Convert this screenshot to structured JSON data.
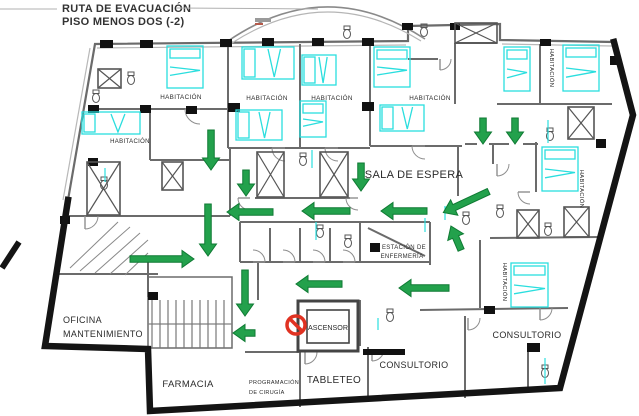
{
  "title": {
    "line1": "RUTA DE EVACUACIÓN",
    "line2": "PISO MENOS DOS (-2)"
  },
  "colors": {
    "outer_wall": "#141414",
    "inner_wall": "#6b6b6b",
    "light_wall": "#b8b8b8",
    "bed": "#2adede",
    "arrow_fill": "#23a14c",
    "arrow_edge": "#0f7a33",
    "prohibited": "#e03222",
    "label": "#2b2b2b",
    "block": "#111111"
  },
  "plan": {
    "outline": [
      [
        95,
        44
      ],
      [
        408,
        41
      ],
      [
        408,
        26
      ],
      [
        500,
        24
      ],
      [
        500,
        40
      ],
      [
        614,
        42
      ],
      [
        633,
        115
      ],
      [
        560,
        388
      ],
      [
        150,
        411
      ],
      [
        148,
        349
      ],
      [
        45,
        346
      ],
      [
        68,
        200
      ]
    ],
    "thick_edge": [
      [
        614,
        42
      ],
      [
        633,
        115
      ],
      [
        560,
        388
      ],
      [
        150,
        411
      ],
      [
        148,
        349
      ],
      [
        45,
        346
      ],
      [
        68,
        200
      ]
    ],
    "thick_stub": [
      2,
      268,
      19,
      242
    ],
    "inner_parallels": [
      [
        97,
        48,
        406,
        45
      ],
      [
        502,
        44,
        612,
        46
      ],
      [
        90,
        48,
        63,
        200
      ]
    ],
    "canopy_paths": [
      "M228,41 Q326,-26 425,39",
      "M232,43 Q326,-18 421,41"
    ],
    "smudges": [
      [
        255,
        18,
        16,
        4,
        "#9a9a9a"
      ],
      [
        255,
        23,
        8,
        2,
        "#b55a4a"
      ]
    ],
    "leaders": [
      [
        0,
        9,
        57,
        9
      ],
      [
        176,
        8,
        318,
        9
      ]
    ],
    "walls": [
      [
        95,
        109,
        228,
        109
      ],
      [
        228,
        44,
        228,
        148
      ],
      [
        300,
        44,
        300,
        148
      ],
      [
        370,
        42,
        370,
        146
      ],
      [
        228,
        148,
        370,
        148
      ],
      [
        370,
        146,
        462,
        146
      ],
      [
        465,
        144,
        477,
        144
      ],
      [
        489,
        144,
        509,
        144
      ],
      [
        523,
        144,
        538,
        144
      ],
      [
        536,
        142,
        536,
        192
      ],
      [
        540,
        44,
        540,
        104
      ],
      [
        497,
        104,
        612,
        104
      ],
      [
        455,
        43,
        455,
        104
      ],
      [
        455,
        43,
        497,
        43
      ],
      [
        408,
        59,
        438,
        59
      ],
      [
        458,
        146,
        458,
        196
      ],
      [
        493,
        144,
        493,
        164
      ],
      [
        490,
        238,
        600,
        237
      ],
      [
        150,
        109,
        150,
        160
      ],
      [
        150,
        160,
        230,
        160
      ],
      [
        230,
        148,
        230,
        216
      ],
      [
        68,
        216,
        230,
        216
      ],
      [
        255,
        198,
        350,
        198
      ],
      [
        240,
        222,
        430,
        222
      ],
      [
        240,
        262,
        430,
        262
      ],
      [
        240,
        222,
        240,
        262
      ],
      [
        270,
        228,
        270,
        262
      ],
      [
        300,
        228,
        300,
        262
      ],
      [
        330,
        228,
        330,
        262
      ],
      [
        360,
        222,
        360,
        262
      ],
      [
        430,
        222,
        430,
        265
      ],
      [
        57,
        274,
        158,
        274
      ],
      [
        258,
        262,
        258,
        300
      ],
      [
        245,
        352,
        300,
        352
      ],
      [
        300,
        350,
        300,
        407
      ],
      [
        368,
        347,
        368,
        402
      ],
      [
        465,
        316,
        465,
        398
      ],
      [
        420,
        310,
        568,
        308
      ],
      [
        480,
        240,
        480,
        308
      ],
      [
        360,
        300,
        360,
        346
      ],
      [
        368,
        228,
        425,
        256
      ],
      [
        528,
        352,
        528,
        392
      ],
      [
        148,
        262,
        148,
        297
      ]
    ],
    "blocks": [
      [
        100,
        40,
        13,
        8
      ],
      [
        140,
        40,
        13,
        8
      ],
      [
        220,
        39,
        12,
        8
      ],
      [
        262,
        38,
        12,
        8
      ],
      [
        312,
        38,
        12,
        8
      ],
      [
        362,
        38,
        12,
        8
      ],
      [
        402,
        23,
        11,
        7
      ],
      [
        450,
        23,
        10,
        7
      ],
      [
        540,
        39,
        11,
        7
      ],
      [
        88,
        105,
        11,
        8
      ],
      [
        140,
        105,
        11,
        8
      ],
      [
        186,
        106,
        11,
        8
      ],
      [
        228,
        103,
        12,
        9
      ],
      [
        362,
        102,
        12,
        9
      ],
      [
        88,
        158,
        10,
        8
      ],
      [
        60,
        216,
        10,
        8
      ],
      [
        370,
        243,
        10,
        9
      ],
      [
        148,
        292,
        10,
        8
      ],
      [
        527,
        343,
        13,
        9
      ],
      [
        363,
        349,
        42,
        6
      ],
      [
        596,
        139,
        10,
        9
      ],
      [
        610,
        56,
        10,
        9
      ],
      [
        484,
        306,
        11,
        8
      ]
    ],
    "shafts": [
      [
        257,
        152,
        27,
        45
      ],
      [
        320,
        152,
        28,
        45
      ],
      [
        455,
        23,
        42,
        20
      ],
      [
        568,
        107,
        26,
        32
      ],
      [
        517,
        210,
        22,
        28
      ],
      [
        564,
        207,
        25,
        30
      ],
      [
        87,
        162,
        33,
        53
      ],
      [
        162,
        162,
        21,
        28
      ],
      [
        98,
        69,
        23,
        19
      ]
    ],
    "beds": [
      [
        167,
        46,
        36,
        42
      ],
      [
        242,
        47,
        52,
        32
      ],
      [
        236,
        110,
        46,
        30
      ],
      [
        302,
        55,
        34,
        30
      ],
      [
        300,
        101,
        26,
        36
      ],
      [
        374,
        47,
        36,
        40
      ],
      [
        380,
        105,
        44,
        26
      ],
      [
        82,
        112,
        58,
        22
      ],
      [
        504,
        47,
        26,
        44
      ],
      [
        563,
        45,
        36,
        46
      ],
      [
        542,
        147,
        36,
        44
      ],
      [
        511,
        263,
        37,
        44
      ]
    ],
    "stairs": {
      "box": [
        148,
        277,
        84,
        71
      ],
      "rail": [
        148,
        324,
        232,
        324
      ],
      "tread_x": [
        152,
        160,
        168,
        176,
        184,
        192,
        200,
        208,
        216,
        224
      ],
      "tread_y1": 300,
      "tread_y2": 348,
      "diagonals": [
        [
          70,
          268,
          118,
          222
        ],
        [
          80,
          271,
          130,
          227
        ],
        [
          95,
          273,
          140,
          233
        ],
        [
          110,
          274,
          148,
          240
        ],
        [
          125,
          275,
          148,
          253
        ]
      ]
    },
    "doors": [
      [
        200,
        109,
        15,
        90
      ],
      [
        285,
        148,
        13,
        90
      ],
      [
        338,
        148,
        13,
        90
      ],
      [
        425,
        146,
        13,
        90
      ],
      [
        250,
        198,
        12,
        90
      ],
      [
        358,
        198,
        12,
        90
      ],
      [
        253,
        262,
        12,
        270
      ],
      [
        283,
        262,
        12,
        270
      ],
      [
        313,
        262,
        12,
        270
      ],
      [
        343,
        262,
        12,
        270
      ],
      [
        85,
        216,
        13,
        0
      ],
      [
        440,
        59,
        11,
        0
      ],
      [
        305,
        352,
        12,
        0
      ],
      [
        372,
        349,
        12,
        0
      ],
      [
        468,
        318,
        12,
        0
      ],
      [
        540,
        308,
        12,
        0
      ],
      [
        530,
        192,
        12,
        90
      ],
      [
        497,
        164,
        12,
        0
      ]
    ],
    "fixtures": [
      [
        96,
        97
      ],
      [
        131,
        79
      ],
      [
        347,
        33
      ],
      [
        424,
        31
      ],
      [
        104,
        184
      ],
      [
        348,
        242
      ],
      [
        466,
        219
      ],
      [
        548,
        230
      ],
      [
        390,
        316
      ],
      [
        545,
        372
      ],
      [
        303,
        160
      ],
      [
        550,
        135
      ],
      [
        500,
        212
      ],
      [
        320,
        232
      ]
    ],
    "cyan_ticks": [
      [
        445,
        206,
        445,
        220
      ],
      [
        312,
        150,
        312,
        168
      ],
      [
        548,
        120,
        548,
        143
      ],
      [
        316,
        222,
        316,
        240
      ],
      [
        105,
        168,
        105,
        182
      ],
      [
        545,
        358,
        545,
        384
      ],
      [
        425,
        218,
        425,
        232
      ],
      [
        378,
        318,
        378,
        330
      ]
    ],
    "arrows": [
      [
        211,
        150,
        40,
        90
      ],
      [
        246,
        183,
        26,
        90
      ],
      [
        361,
        177,
        28,
        90
      ],
      [
        483,
        131,
        26,
        90
      ],
      [
        515,
        131,
        26,
        90
      ],
      [
        250,
        212,
        46,
        180
      ],
      [
        326,
        211,
        48,
        180
      ],
      [
        404,
        211,
        46,
        180
      ],
      [
        466,
        202,
        50,
        155
      ],
      [
        456,
        238,
        26,
        247
      ],
      [
        208,
        230,
        52,
        90
      ],
      [
        162,
        259,
        64,
        0
      ],
      [
        245,
        293,
        46,
        90
      ],
      [
        244,
        333,
        22,
        180
      ],
      [
        319,
        284,
        46,
        180
      ],
      [
        424,
        288,
        50,
        180
      ]
    ],
    "elevator": {
      "outer": [
        298,
        301,
        60,
        50
      ],
      "inner": [
        307,
        310,
        42,
        33
      ],
      "label": "ASCENSOR",
      "label_x": 328,
      "label_y": 330
    },
    "prohibition": {
      "x": 296,
      "y": 325,
      "r": 9
    },
    "labels": [
      {
        "id": "habitacion-1",
        "t": "HABITACIÓN",
        "x": 181,
        "y": 99,
        "s": 6.3
      },
      {
        "id": "habitacion-2",
        "t": "HABITACIÓN",
        "x": 267,
        "y": 100,
        "s": 6.3
      },
      {
        "id": "habitacion-3",
        "t": "HABITACIÓN",
        "x": 332,
        "y": 100,
        "s": 6.3
      },
      {
        "id": "habitacion-4",
        "t": "HABITACIÓN",
        "x": 430,
        "y": 100,
        "s": 6.3
      },
      {
        "id": "habitacion-5",
        "t": "HABITACIÓN",
        "x": 130,
        "y": 143,
        "s": 6
      },
      {
        "id": "habitacion-6",
        "t": "HABITACIÓN",
        "x": 550,
        "y": 68,
        "s": 5.8,
        "r": 90
      },
      {
        "id": "habitacion-7",
        "t": "HABITACIÓN",
        "x": 580,
        "y": 189,
        "s": 5.8,
        "r": 90
      },
      {
        "id": "habitacion-8",
        "t": "HABITACIÓN",
        "x": 503,
        "y": 282,
        "s": 5.8,
        "r": 90
      },
      {
        "id": "sala-de-espera",
        "t": "SALA DE ESPERA",
        "x": 414,
        "y": 178,
        "s": 11
      },
      {
        "id": "estacion-1",
        "t": "ESTACIÓN DE",
        "x": 404,
        "y": 249,
        "s": 6
      },
      {
        "id": "estacion-2",
        "t": "ENFERMERÍA",
        "x": 402,
        "y": 258,
        "s": 6
      },
      {
        "id": "oficina-1",
        "t": "OFICINA",
        "x": 63,
        "y": 323,
        "s": 9,
        "a": "start"
      },
      {
        "id": "oficina-2",
        "t": "MANTENIMIENTO",
        "x": 63,
        "y": 337,
        "s": 9,
        "a": "start"
      },
      {
        "id": "farmacia",
        "t": "FARMACIA",
        "x": 188,
        "y": 387,
        "s": 9.5
      },
      {
        "id": "programacion-1",
        "t": "PROGRAMACIÓN",
        "x": 249,
        "y": 384,
        "s": 5.5,
        "a": "start"
      },
      {
        "id": "programacion-2",
        "t": "DE CIRUGÍA",
        "x": 249,
        "y": 394,
        "s": 5.5,
        "a": "start"
      },
      {
        "id": "tableteo",
        "t": "TABLETEO",
        "x": 334,
        "y": 383,
        "s": 10
      },
      {
        "id": "consultorio-1",
        "t": "CONSULTORIO",
        "x": 414,
        "y": 368,
        "s": 9
      },
      {
        "id": "consultorio-2",
        "t": "CONSULTORIO",
        "x": 527,
        "y": 338,
        "s": 9
      }
    ]
  }
}
